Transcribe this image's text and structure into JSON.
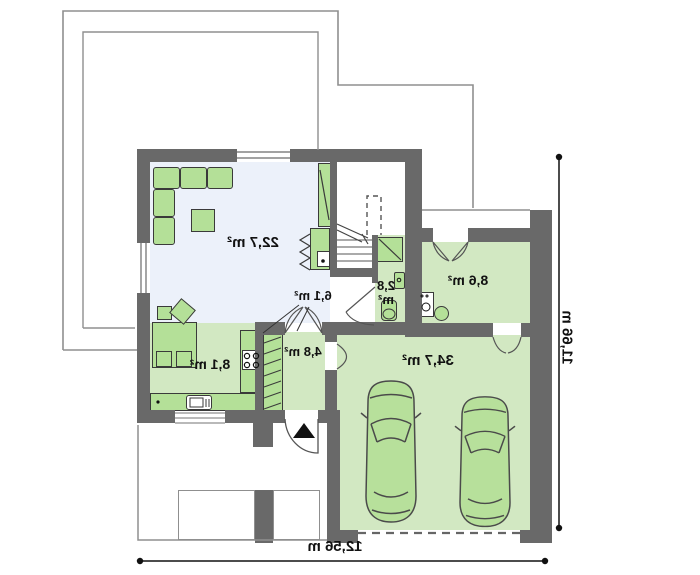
{
  "floor_plan": {
    "rooms": {
      "living_room": {
        "area_label": "22,7 m²"
      },
      "hall": {
        "area_label": "6,1 m²"
      },
      "wc": {
        "area_value": "2,8",
        "area_unit": "m²"
      },
      "utility_room": {
        "area_label": "8,6 m²"
      },
      "garage": {
        "area_label": "34,7 m²"
      },
      "vestibule": {
        "area_label": "4,8 m²"
      },
      "kitchen": {
        "area_label": "8,1 m²"
      }
    },
    "dimensions": {
      "overall_width": "12,56 m",
      "overall_height": "11,66 m"
    },
    "colors": {
      "wall": "#696969",
      "floor_light": "#ecf1fa",
      "floor_green": "#d2e8c2",
      "furniture_green": "#b4e098"
    }
  }
}
